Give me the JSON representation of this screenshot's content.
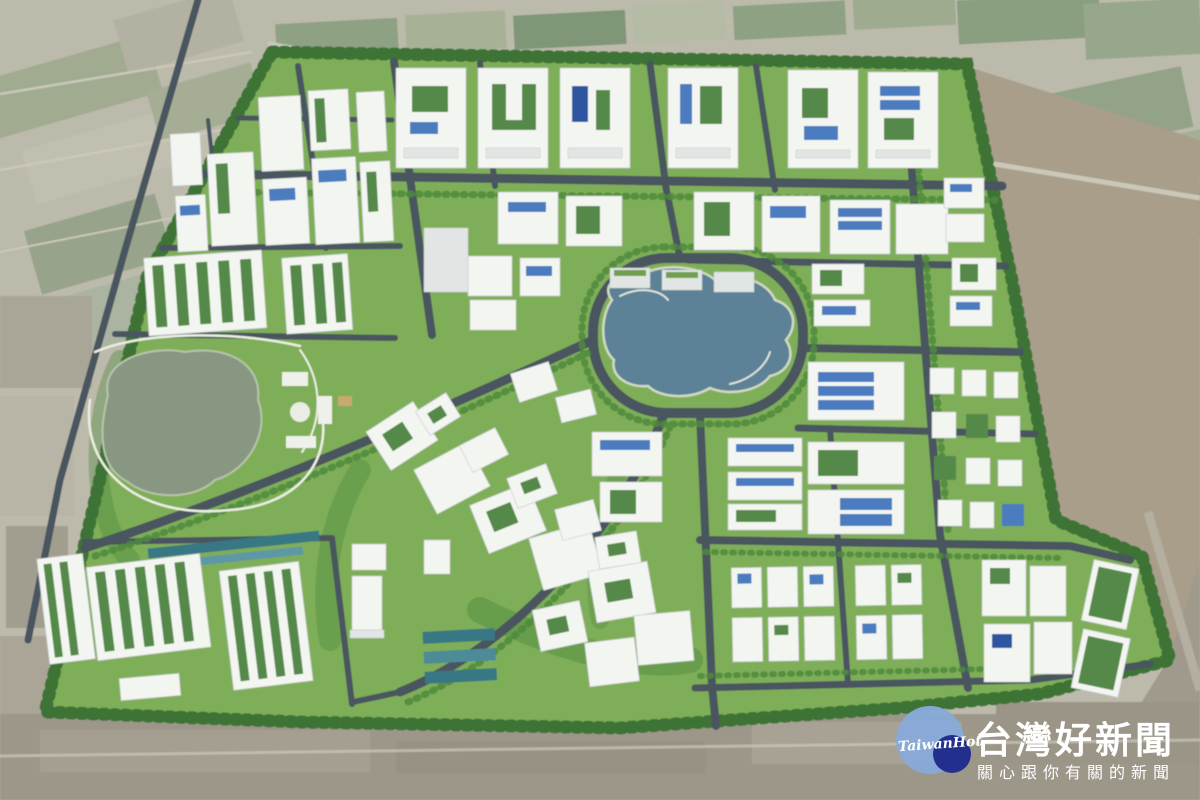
{
  "watermark": {
    "logo_text": "TaiwanHot",
    "title": "台灣好新聞",
    "subtitle": "關心跟你有關的新聞"
  },
  "palette": {
    "farmland_base": "#bcbaab",
    "field_tan": "#a89e8a",
    "park_green": "#7fae58",
    "road_gray": "#4a555f",
    "tree_green": "#4e8a3e",
    "treeline_green": "#3c7336",
    "lake_center": "#5d8196",
    "lake_west": "#879782",
    "building_white": "#f3f5f1",
    "building_edge": "#c6cbcd",
    "roof_green": "#55894a",
    "solar_blue": "#4b7cc0",
    "path_white": "#eaeee2",
    "logo_blue": "#88aad8",
    "logo_navy": "#232f8c",
    "text_white": "#ffffff"
  }
}
